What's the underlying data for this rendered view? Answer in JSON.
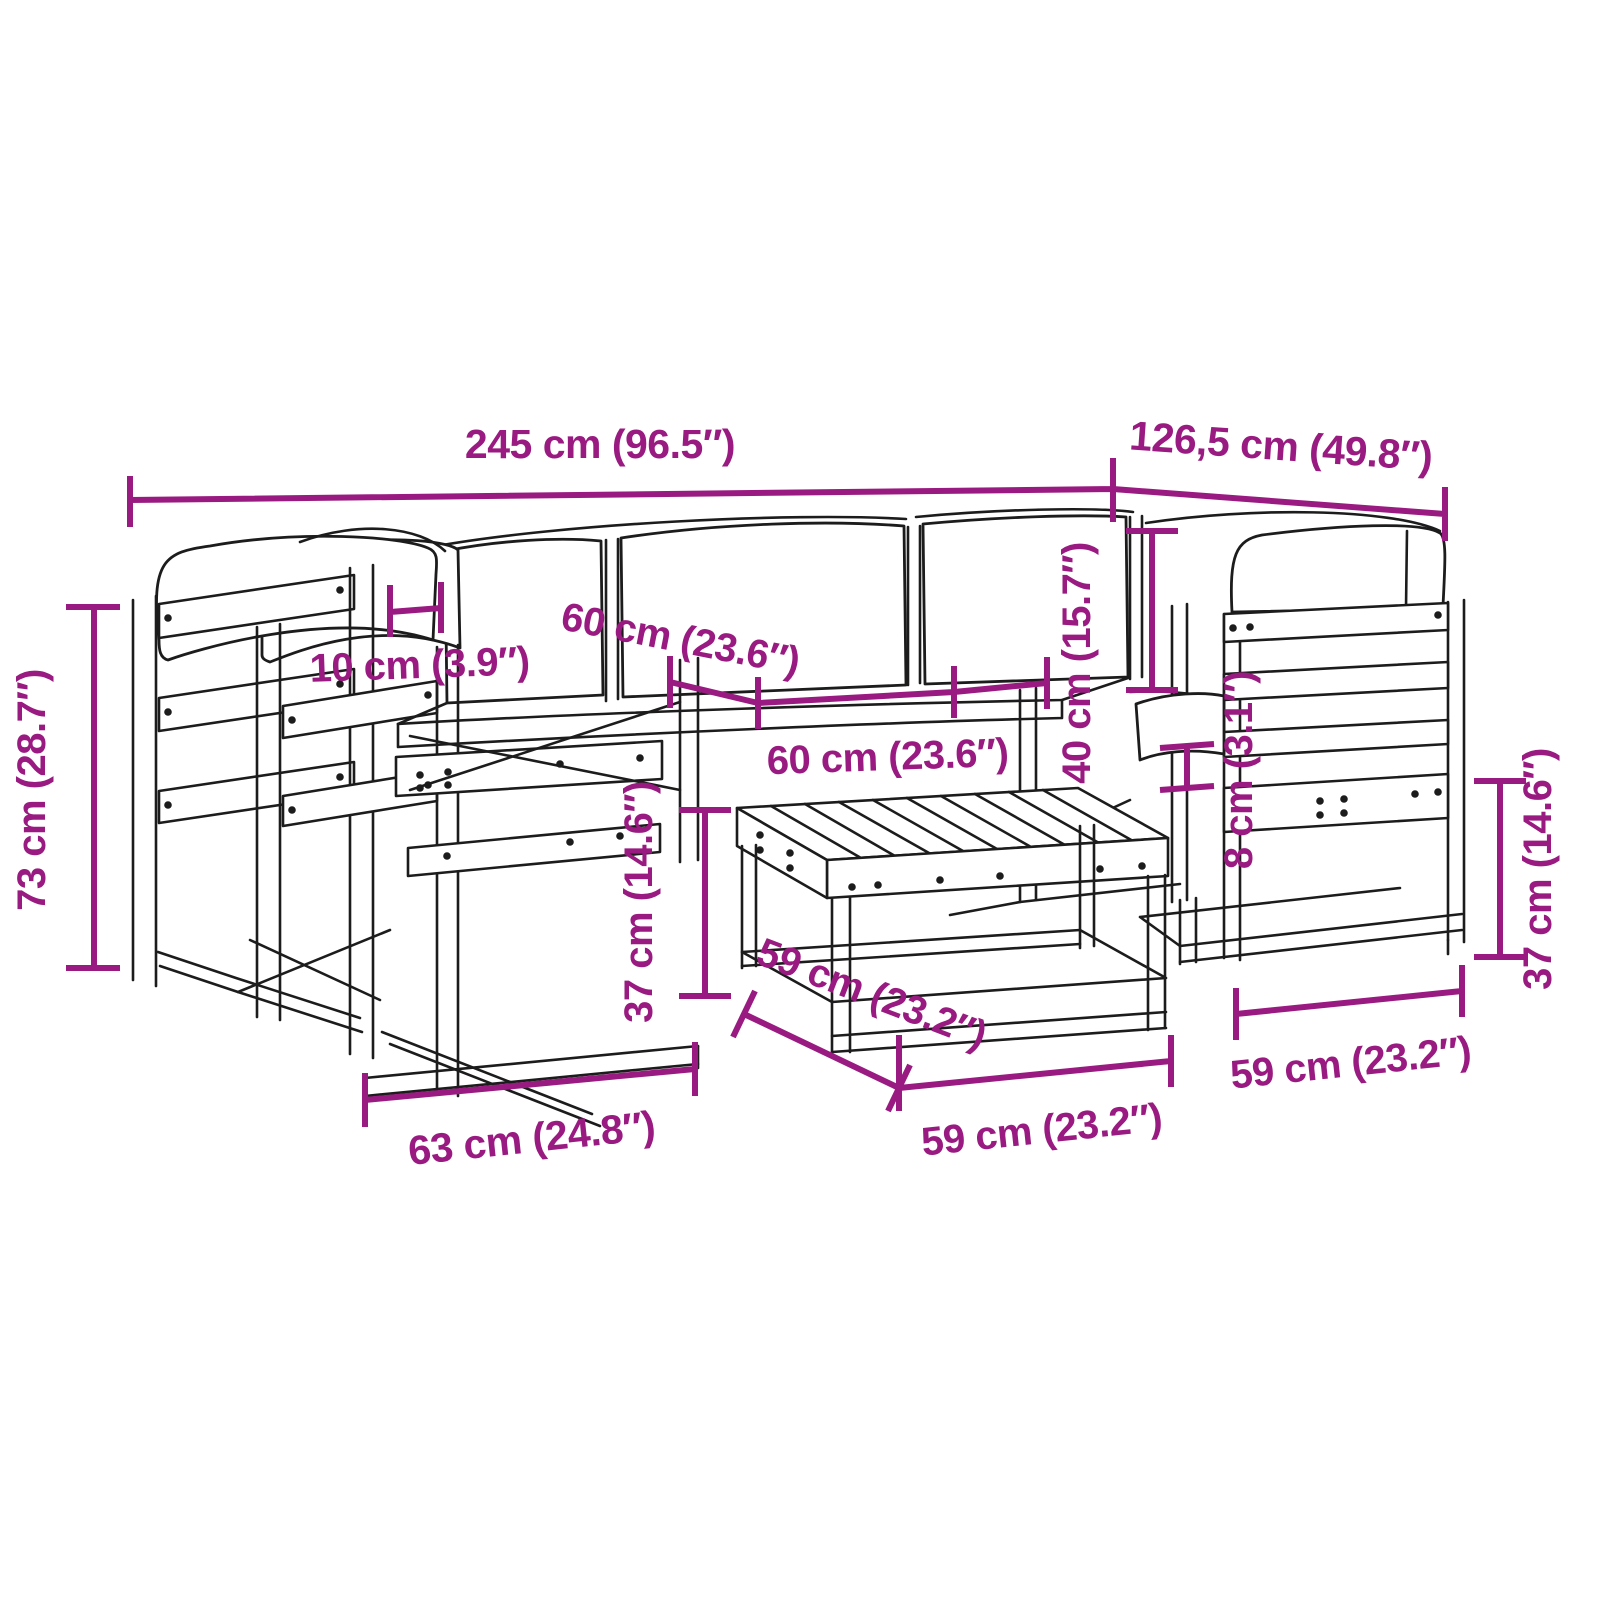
{
  "figure": {
    "type": "product dimension diagram",
    "subject": "garden lounge furniture set line drawing with cushions and slatted table",
    "accent_color": "#991a80",
    "line_color": "#1c1c1c",
    "background_color": "#ffffff"
  },
  "dims": {
    "total_width": "245 cm (96.5″)",
    "total_depth": "126,5 cm (49.8″)",
    "back_height": "73 cm (28.7″)",
    "cushion_gap": "10 cm (3.9″)",
    "seat_width_a": "60 cm (23.6″)",
    "seat_width_b": "60 cm (23.6″)",
    "backrest_height": "40 cm (15.7″)",
    "armrest_offset": "8 cm (3.1″)",
    "table_height": "37 cm (14.6″)",
    "table_depth": "59 cm (23.2″)",
    "table_width": "59 cm (23.2″)",
    "chair_width": "59 cm (23.2″)",
    "seat_height": "37 cm (14.6″)",
    "seat_depth": "63 cm (24.8″)"
  }
}
